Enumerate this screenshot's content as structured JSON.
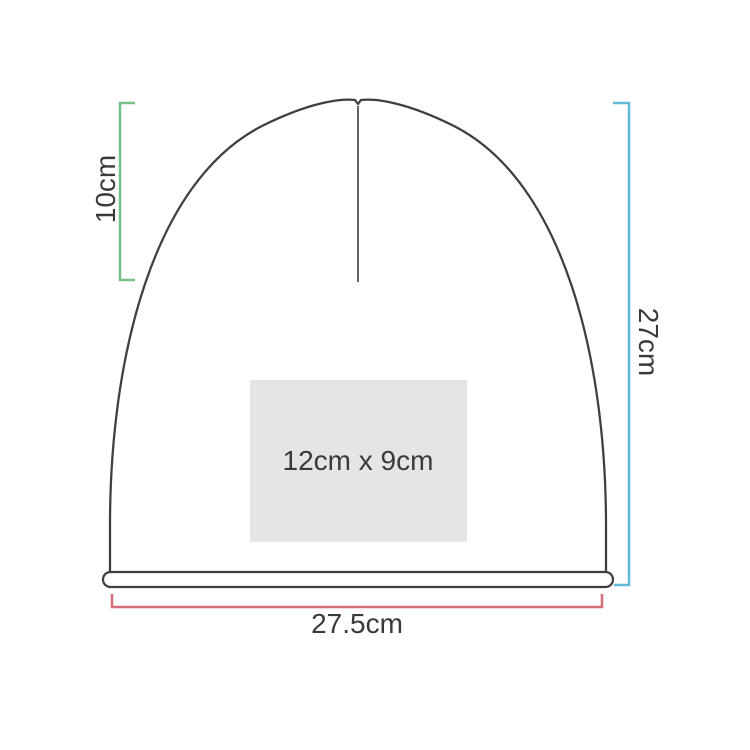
{
  "diagram": {
    "product": "beanie-dimension-diagram",
    "labels": {
      "crown_height": "10cm",
      "total_height": "27cm",
      "width": "27.5cm",
      "print_area": "12cm x 9cm"
    },
    "colors": {
      "crown_bracket": "#76c286",
      "height_bracket": "#64b9d9",
      "width_bracket": "#d66e79",
      "outline": "#3f3f3f",
      "seam": "#636363",
      "print_area_fill": "#e4e5e7",
      "label_text": "#3a3a3a",
      "background": "#ffffff"
    }
  }
}
